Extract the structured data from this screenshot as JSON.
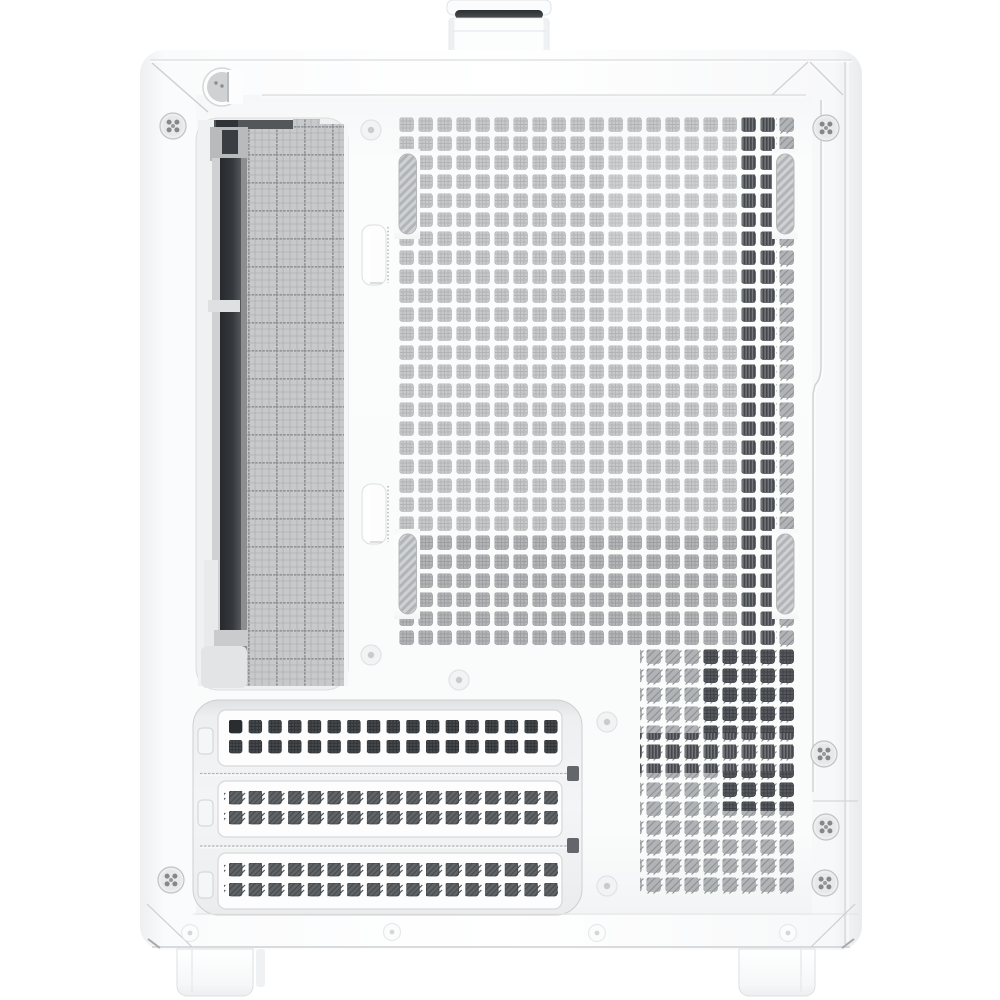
{
  "scene": {
    "description": "Product photo: white compact PC tower case seen from the rear-side, with a top carry handle, perforated square-hole mesh panel, fine-mesh radiator grille window with a dark bracket bar, four capsule vent slots, three horizontal expansion-slot covers and two bottom feet",
    "background_color": "#ffffff"
  },
  "colors": {
    "body_white": "#fcfdfe",
    "panel_tint": "#f7f8f9",
    "seam_gray": "#d5d7d9",
    "mesh_hole_light": "#c7c9cb",
    "mesh_hole_medium": "#b3b5b7",
    "mesh_stripe_dark": "#43474b",
    "mesh_hole_dark": "#55595d",
    "interior_bar_dark": "#2e3135",
    "slot_hole_dark": "#45494c",
    "slot_hole_striped": "#606467",
    "handle_slot_dark": "#34373a",
    "screw_gray": "#808386"
  },
  "parts": {
    "handle": {
      "label": "top carry handle with dark grip slot"
    },
    "thumbscrew_recess": {
      "label": "round thumbscrew recess at top-left"
    },
    "radiator_window": {
      "label": "radiator and fan grille window with fine mesh and dark bracket bar"
    },
    "mesh_panel": {
      "label": "perforated square-hole mesh panel",
      "columns": 21,
      "rows": 28
    },
    "mesh_block_lower_right": {
      "label": "lower-right mesh section",
      "columns": 8,
      "rows": 13
    },
    "vent_slots": {
      "label": "capsule-shaped vent slots",
      "count": 4
    },
    "clip_tabs": {
      "label": "white clip tabs beside grille window",
      "count": 2
    },
    "expansion_slot_covers": {
      "label": "horizontal expansion slot covers",
      "count": 3,
      "holes_per_cover": "2 rows x 17 columns"
    },
    "slot_side_tabs": {
      "label": "retention tabs left of slot covers",
      "count": 3
    },
    "screws": {
      "label": "crosshead panel screws",
      "count": 6
    },
    "rivets": {
      "label": "round panel rivets",
      "count": 5
    },
    "bottom_detents": {
      "label": "bottom rail detents",
      "count": 4
    },
    "feet": {
      "label": "case feet",
      "count": 2
    }
  }
}
